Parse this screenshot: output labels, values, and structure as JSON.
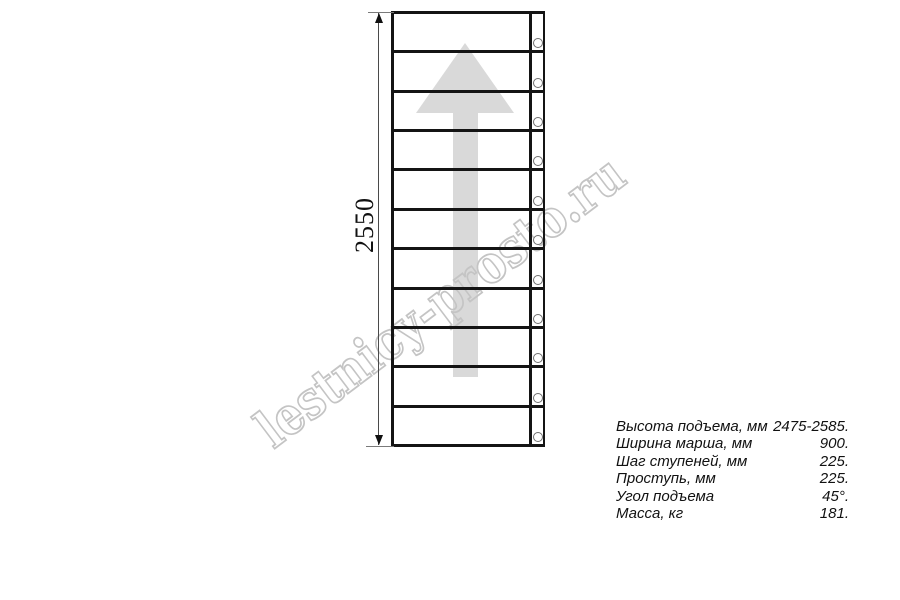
{
  "page": {
    "background_color": "#ffffff",
    "line_color": "#141414",
    "arrow_color": "#d9d9d9",
    "watermark_color": "#c4c4c4"
  },
  "watermark": {
    "text": "lestnicy-prosto.ru"
  },
  "diagram": {
    "type": "staircase-plan-view",
    "dimension_label": "2550",
    "step_count": 11,
    "hole_count": 11,
    "direction_arrow": "up"
  },
  "specs": {
    "rows": [
      {
        "label": "Высота подъема, мм",
        "value": "2475-2585."
      },
      {
        "label": "Ширина марша, мм",
        "value": "900."
      },
      {
        "label": "Шаг ступеней, мм",
        "value": "225."
      },
      {
        "label": "Проступь, мм",
        "value": "225."
      },
      {
        "label": "Угол подъема",
        "value": "45°."
      },
      {
        "label": "Масса, кг",
        "value": "181."
      }
    ]
  }
}
